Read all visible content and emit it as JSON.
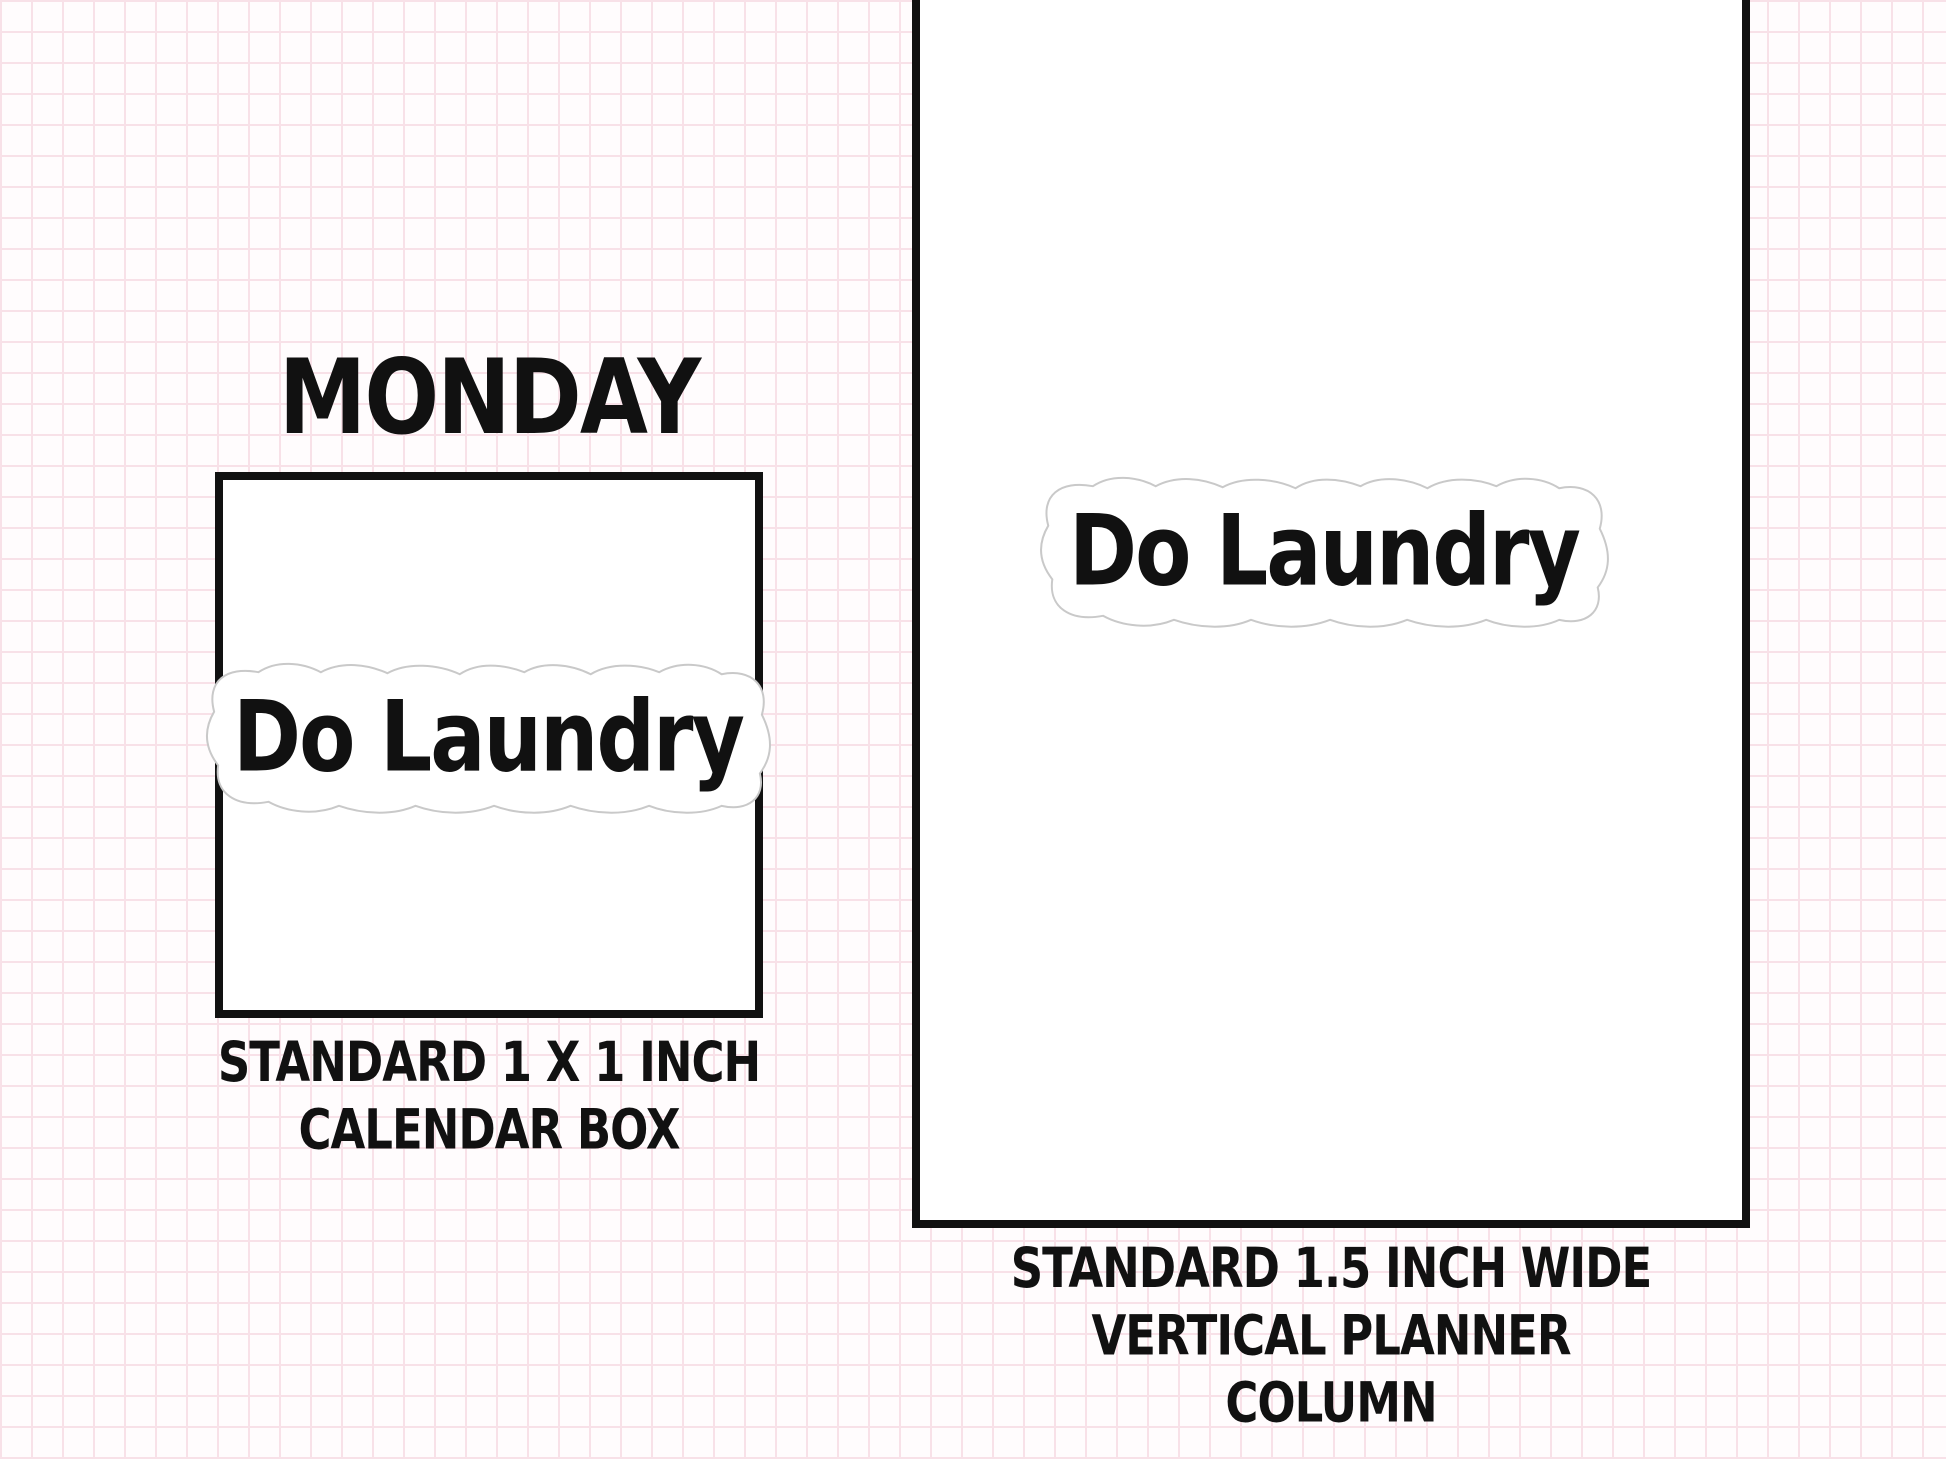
{
  "background": {
    "style": "pink graph-paper grid on white",
    "grid_cell_px": 31,
    "grid_line_color": "#f8e1e8",
    "page_color": "#fffcfd"
  },
  "colors": {
    "ink": "#111111",
    "box_border": "#111111",
    "sticker_fill": "#ffffff",
    "sticker_diecut_outline": "#c9c9c9"
  },
  "left_panel": {
    "day_label": "MONDAY",
    "sticker_text": "Do Laundry",
    "caption_line1": "STANDARD 1 X 1 INCH",
    "caption_line2": "CALENDAR BOX"
  },
  "right_panel": {
    "sticker_text": "Do Laundry",
    "caption_line1": "STANDARD 1.5 INCH WIDE",
    "caption_line2": "VERTICAL PLANNER COLUMN"
  }
}
